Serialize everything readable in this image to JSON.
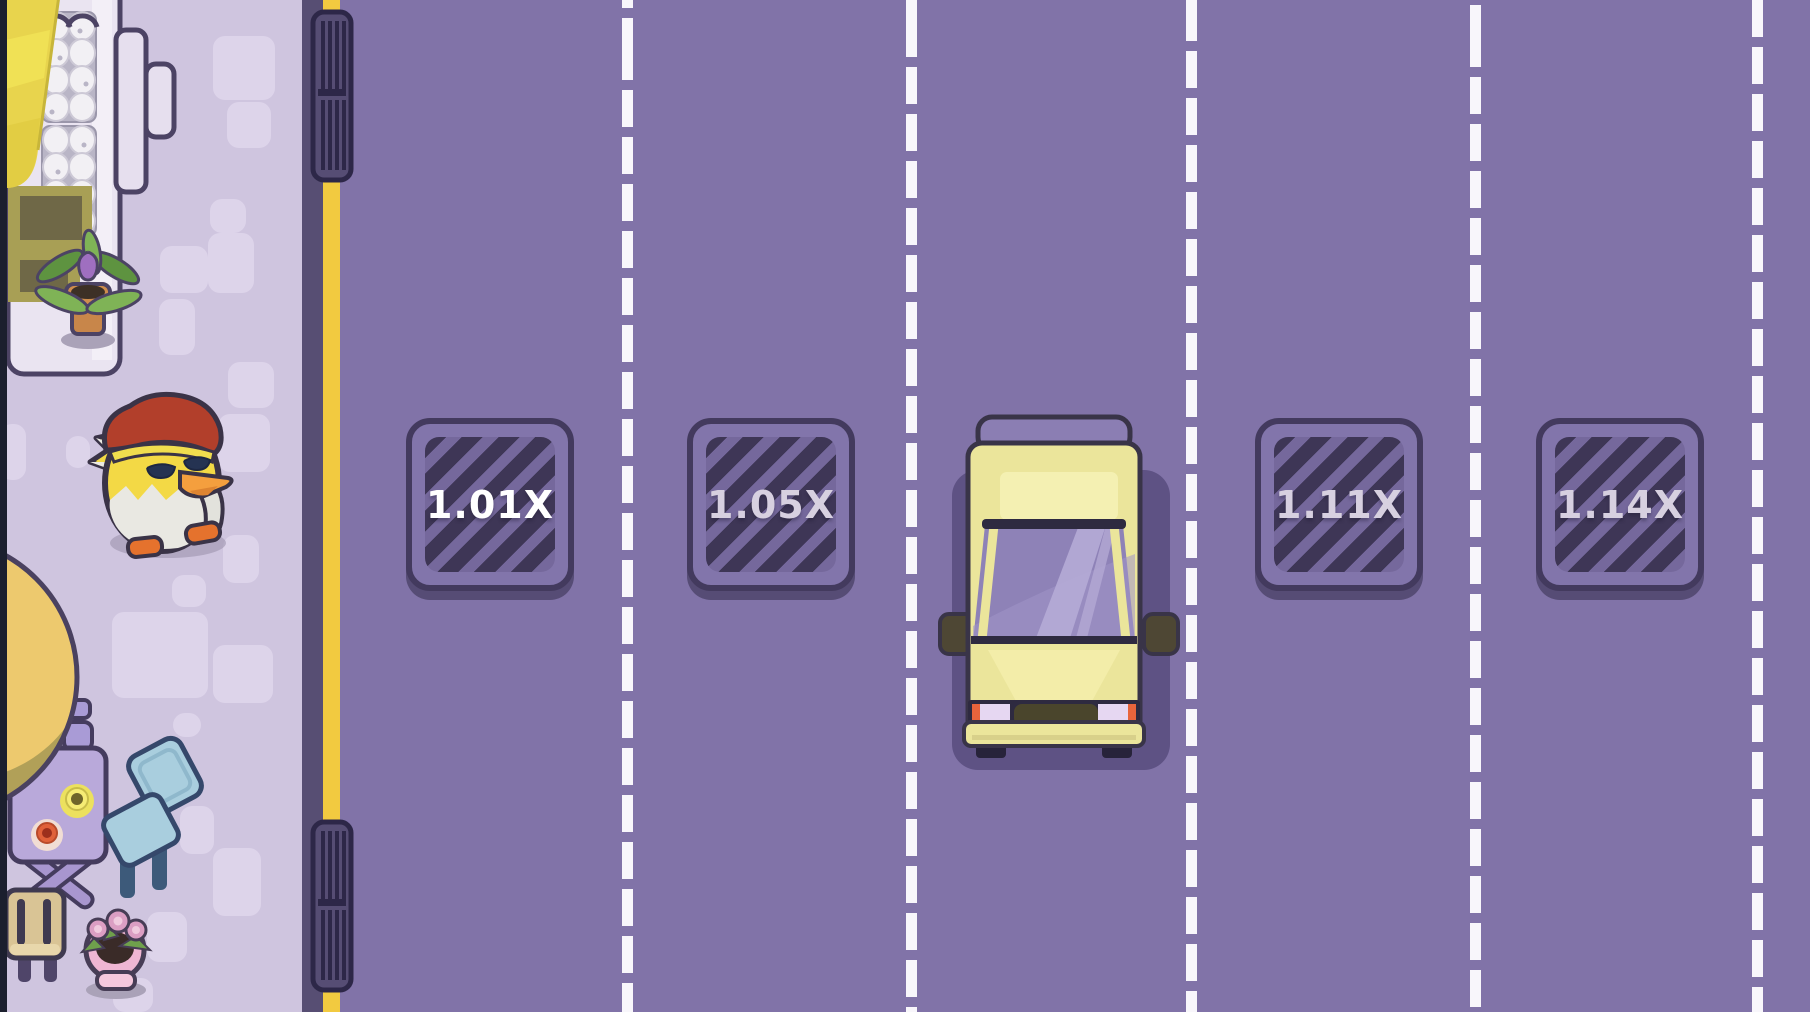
{
  "meta": {
    "app": "chicken-road-crossing-game",
    "scene": "road-crossing-playfield"
  },
  "game": {
    "lanes": [
      {
        "index": 1,
        "multiplier": "1.01X",
        "occupied_by": null
      },
      {
        "index": 2,
        "multiplier": "1.05X",
        "occupied_by": null
      },
      {
        "index": 3,
        "multiplier": null,
        "occupied_by": "yellow-car"
      },
      {
        "index": 4,
        "multiplier": "1.11X",
        "occupied_by": null
      },
      {
        "index": 5,
        "multiplier": "1.14X",
        "occupied_by": null
      }
    ],
    "player": {
      "character": "chicken",
      "accessory": "red-cap",
      "location": "sidewalk"
    }
  },
  "theme": {
    "colors": {
      "road": "#8173a8",
      "lane-dash": "#f8f6fb",
      "sidewalk": "#cfc5df",
      "sidewalk-tile": "#ddd4ea",
      "curb-dark": "#574e73",
      "curb-yellow": "#f2ca40",
      "edge-strip": "#1b1f2e",
      "tile-frame": "#8275ab",
      "tile-border": "#433a5e",
      "tile-stripe-dark": "#3e3656",
      "tile-stripe-light": "#75689c",
      "tile-text": "#ffffff",
      "tile-text-dim": "#d7d0e0",
      "shadow-purple": "#5e5284",
      "car-body": "#ebe59b",
      "car-roof": "#8b7eb3",
      "car-glass": "#8e82b7",
      "car-outline": "#393448",
      "vent-body": "#564d74",
      "vent-slat": "#2d2748",
      "awning-yellow": "#e8d44d",
      "awning-light": "#f0e155",
      "olive": "#a89f55",
      "olive-dark": "#6f6847",
      "shop-floor": "#eae4f1",
      "shop-outline": "#4c4364",
      "egg-white": "#f2f0f4",
      "egg-tray": "#b9b5c6",
      "table-purple": "#b9a9da",
      "table-outline": "#453c5e",
      "chair-blue": "#a9cede",
      "chair-outline": "#35486b",
      "stool-tan": "#d9c495",
      "pot-pink": "#efb6d3",
      "pot-terracotta": "#c8864a",
      "leaf-green": "#7fb356",
      "umbrella-yellow": "#edc96e",
      "umbrella-shade": "#b1a058",
      "chicken-yellow": "#f3d945",
      "chicken-cap": "#b23f2b",
      "chicken-white": "#e9e8e2",
      "chicken-beak": "#f49f3e",
      "chicken-feet": "#e5722d",
      "outline-dark": "#3a3347"
    }
  }
}
